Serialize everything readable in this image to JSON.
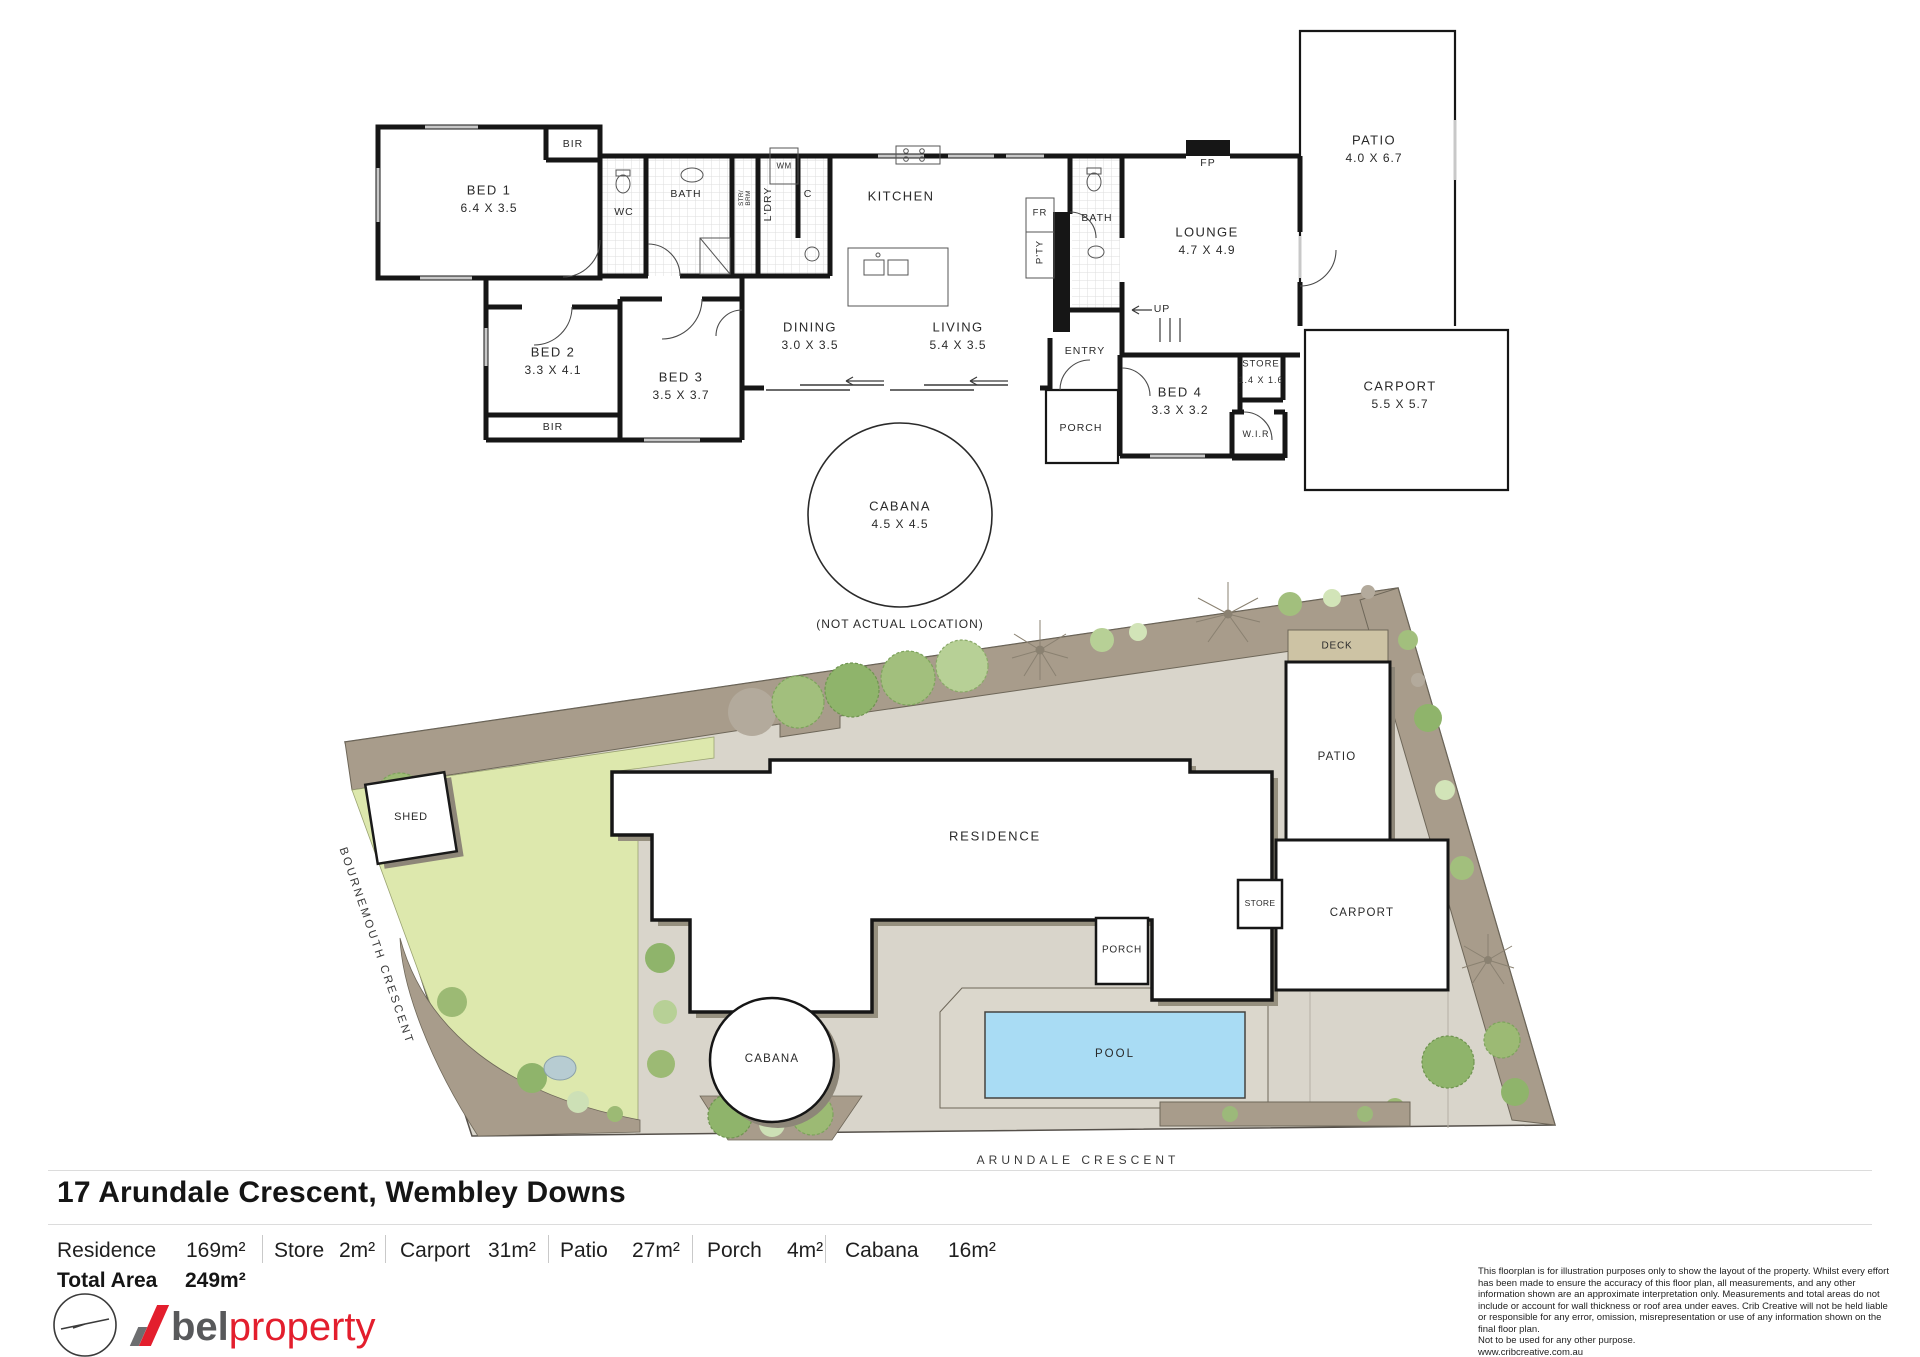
{
  "floorplan": {
    "rooms": [
      {
        "name": "BED 1",
        "dims": "6.4 X 3.5"
      },
      {
        "name": "BED 2",
        "dims": "3.3 X 4.1"
      },
      {
        "name": "BED 3",
        "dims": "3.5 X 3.7"
      },
      {
        "name": "DINING",
        "dims": "3.0 X 3.5"
      },
      {
        "name": "LIVING",
        "dims": "5.4 X 3.5"
      },
      {
        "name": "KITCHEN",
        "dims": ""
      },
      {
        "name": "LOUNGE",
        "dims": "4.7 X 4.9"
      },
      {
        "name": "PATIO",
        "dims": "4.0 X 6.7"
      },
      {
        "name": "CARPORT",
        "dims": "5.5 X 5.7"
      },
      {
        "name": "STORE",
        "dims": "1.4 X 1.6"
      },
      {
        "name": "BED 4",
        "dims": "3.3 X 3.2"
      },
      {
        "name": "CABANA",
        "dims": "4.5 X 4.5"
      }
    ],
    "labels": {
      "bir1": "BIR",
      "bir2": "BIR",
      "wc": "WC",
      "bath1": "BATH",
      "bath2": "BATH",
      "strbrm1": "STR/",
      "strbrm2": "BRM",
      "ldry": "L'DRY",
      "wm": "WM",
      "c": "C",
      "fr": "FR",
      "pty": "P'TY",
      "fp": "FP",
      "up": "UP",
      "entry": "ENTRY",
      "porch": "PORCH",
      "wir": "W.I.R"
    },
    "note": "(NOT ACTUAL LOCATION)"
  },
  "siteplan": {
    "labels": {
      "shed": "SHED",
      "deck": "DECK",
      "patio": "PATIO",
      "residence": "RESIDENCE",
      "store": "STORE",
      "carport": "CARPORT",
      "porch": "PORCH",
      "cabana": "CABANA",
      "pool": "POOL"
    },
    "streets": {
      "left": "BOURNEMOUTH CRESCENT",
      "bottom": "ARUNDALE CRESCENT"
    }
  },
  "footer": {
    "title": "17 Arundale Crescent, Wembley Downs",
    "areas": [
      {
        "label": "Residence",
        "value": "169m²"
      },
      {
        "label": "Store",
        "value": "2m²"
      },
      {
        "label": "Carport",
        "value": "31m²"
      },
      {
        "label": "Patio",
        "value": "27m²"
      },
      {
        "label": "Porch",
        "value": "4m²"
      },
      {
        "label": "Cabana",
        "value": "16m²"
      }
    ],
    "total_label": "Total Area",
    "total_value": "249m²",
    "logo": {
      "bold": "bel",
      "light": "property"
    },
    "disclaimer": "This floorplan is for illustration purposes only to show the layout of the property. Whilst every effort has been made to ensure the accuracy of this floor plan, all measurements, and any other information shown are an approximate interpretation only. Measurements and total areas do not include or account for wall thickness or roof area under eaves. Crib Creative will not be held liable or responsible for any error, omission, misrepresentation or use of any information shown on the final floor plan.\nNot to be used for any other purpose.\nwww.cribcreative.com.au"
  },
  "colors": {
    "accent_red": "#e31e2d",
    "logo_gray": "#58595b",
    "pool_blue": "#a9dcf4",
    "lawn_green": "#dde8ad",
    "garden_taupe": "#a89c8b",
    "paving": "#d9d5cb",
    "wall": "#161616"
  }
}
